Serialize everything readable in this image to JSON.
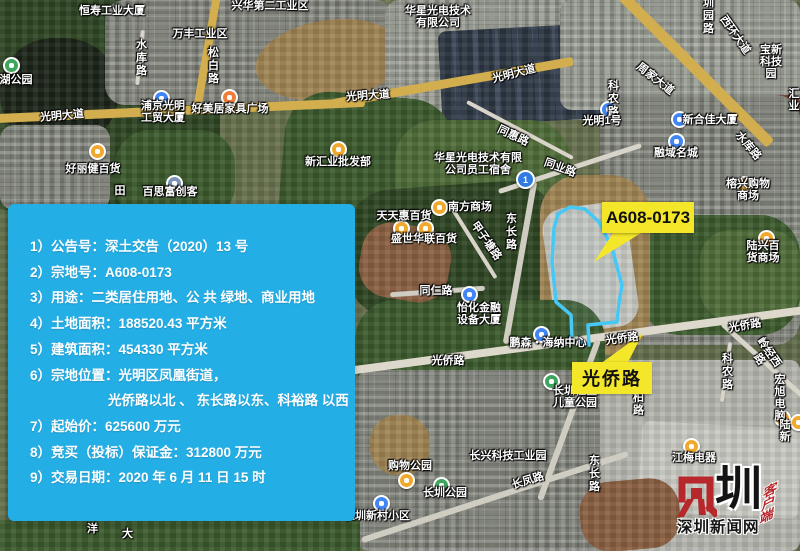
{
  "callouts": {
    "parcel": "A608-0173",
    "road": "光侨路"
  },
  "info_box": {
    "lines": [
      {
        "t": "1）公告号：深土交告（2020）13 号",
        "indent": false
      },
      {
        "t": "2）宗地号：A608-0173",
        "indent": false
      },
      {
        "t": "3）用途：二类居住用地、公 共 绿地、商业用地",
        "indent": false
      },
      {
        "t": "4）土地面积：188520.43 平方米",
        "indent": false
      },
      {
        "t": "5）建筑面积：454330 平方米",
        "indent": false
      },
      {
        "t": "6）宗地位置：光明区凤凰街道，",
        "indent": false
      },
      {
        "t": "光侨路以北 、 东长路以东、科裕路 以西",
        "indent": true
      },
      {
        "t": "7）起始价：625600 万元",
        "indent": false
      },
      {
        "t": "8）竞买（投标）保证金：312800 万元",
        "indent": false
      },
      {
        "t": "9）交易日期：2020 年 6 月 11 日 15 时",
        "indent": false
      }
    ]
  },
  "map": {
    "route_badge": "1",
    "labels": [
      {
        "t": "恒寿工业大厦",
        "x": 112,
        "y": 11
      },
      {
        "t": "兴华第二工业区",
        "x": 270,
        "y": 6
      },
      {
        "t": "万丰工业区",
        "x": 200,
        "y": 34
      },
      {
        "t": "水库路",
        "x": 140,
        "y": 58,
        "v": true
      },
      {
        "t": "松白路",
        "x": 212,
        "y": 66,
        "v": true
      },
      {
        "t": "光明大道",
        "x": 62,
        "y": 116,
        "rot": -5
      },
      {
        "t": "浦京光明\n工贸大厦",
        "x": 163,
        "y": 112
      },
      {
        "t": "好美居家具广场",
        "x": 230,
        "y": 109
      },
      {
        "t": "湖公园",
        "x": 16,
        "y": 80
      },
      {
        "t": "好丽健百货",
        "x": 93,
        "y": 169
      },
      {
        "t": "百思富创客",
        "x": 170,
        "y": 192
      },
      {
        "t": "田",
        "x": 120,
        "y": 191
      },
      {
        "t": "新汇业批发部",
        "x": 338,
        "y": 162
      },
      {
        "t": "光明大道",
        "x": 368,
        "y": 96,
        "rot": -4
      },
      {
        "t": "光明大道",
        "x": 514,
        "y": 74,
        "rot": -14
      },
      {
        "t": "华星光电技术\n有限公司",
        "x": 438,
        "y": 17
      },
      {
        "t": "圳园路",
        "x": 707,
        "y": 16,
        "v": true
      },
      {
        "t": "西环大道",
        "x": 735,
        "y": 35,
        "rot": 55
      },
      {
        "t": "宝新科技园",
        "x": 771,
        "y": 62
      },
      {
        "t": "周家大道",
        "x": 655,
        "y": 79,
        "rot": 38
      },
      {
        "t": "科农路",
        "x": 612,
        "y": 99,
        "v": true
      },
      {
        "t": "光明1号",
        "x": 602,
        "y": 121
      },
      {
        "t": "新合佳大厦",
        "x": 710,
        "y": 120
      },
      {
        "t": "融域名城",
        "x": 676,
        "y": 153
      },
      {
        "t": "水库路",
        "x": 748,
        "y": 146,
        "rot": 50
      },
      {
        "t": "汇业",
        "x": 794,
        "y": 100
      },
      {
        "t": "同惠路",
        "x": 513,
        "y": 136,
        "rot": 25
      },
      {
        "t": "华星光电技术有限\n公司员工宿舍",
        "x": 478,
        "y": 164
      },
      {
        "t": "同业路",
        "x": 560,
        "y": 168,
        "rot": 20
      },
      {
        "t": "南方商场",
        "x": 470,
        "y": 207
      },
      {
        "t": "天天惠百货",
        "x": 404,
        "y": 216
      },
      {
        "t": "盛世华联百货",
        "x": 424,
        "y": 239
      },
      {
        "t": "东长路",
        "x": 510,
        "y": 232,
        "v": true
      },
      {
        "t": "甲子塘路",
        "x": 486,
        "y": 241,
        "rot": 55
      },
      {
        "t": "同仁路",
        "x": 436,
        "y": 291
      },
      {
        "t": "榕兴购物商场",
        "x": 748,
        "y": 190
      },
      {
        "t": "陆兴百货商场",
        "x": 763,
        "y": 252
      },
      {
        "t": "怡化金融\n设备大厦",
        "x": 479,
        "y": 314
      },
      {
        "t": "鹏森・海纳中心",
        "x": 548,
        "y": 343
      },
      {
        "t": "光侨路",
        "x": 622,
        "y": 339,
        "rot": -8
      },
      {
        "t": "光侨路",
        "x": 448,
        "y": 361
      },
      {
        "t": "光侨路",
        "x": 745,
        "y": 326,
        "rot": -10
      },
      {
        "t": "岭经西路",
        "x": 764,
        "y": 356,
        "rot": 55
      },
      {
        "t": "科农路",
        "x": 726,
        "y": 372,
        "v": true
      },
      {
        "t": "柏路",
        "x": 637,
        "y": 404,
        "v": true
      },
      {
        "t": "长圳社区\n儿童公园",
        "x": 575,
        "y": 397
      },
      {
        "t": "长兴科技工业园",
        "x": 508,
        "y": 456
      },
      {
        "t": "长凤路",
        "x": 528,
        "y": 481,
        "rot": -17
      },
      {
        "t": "东长路",
        "x": 593,
        "y": 474,
        "v": true
      },
      {
        "t": "购物公园",
        "x": 410,
        "y": 466
      },
      {
        "t": "长圳公园",
        "x": 445,
        "y": 493
      },
      {
        "t": "长圳新村小区",
        "x": 377,
        "y": 516
      },
      {
        "t": "宏旭电脑",
        "x": 780,
        "y": 398
      },
      {
        "t": "陆新",
        "x": 785,
        "y": 431
      },
      {
        "t": "江梅电器",
        "x": 694,
        "y": 458
      },
      {
        "t": "洋",
        "x": 91,
        "y": 529,
        "v": true
      },
      {
        "t": "大",
        "x": 126,
        "y": 534,
        "v": true
      }
    ],
    "icons": [
      {
        "kind": "park",
        "x": 10,
        "y": 64
      },
      {
        "kind": "place",
        "x": 160,
        "y": 97
      },
      {
        "kind": "furniture",
        "x": 228,
        "y": 96
      },
      {
        "kind": "shopping",
        "x": 96,
        "y": 150
      },
      {
        "kind": "office",
        "x": 173,
        "y": 182
      },
      {
        "kind": "shopping",
        "x": 337,
        "y": 148
      },
      {
        "kind": "shopping",
        "x": 438,
        "y": 206
      },
      {
        "kind": "shopping",
        "x": 400,
        "y": 227
      },
      {
        "kind": "shopping",
        "x": 424,
        "y": 227
      },
      {
        "kind": "route",
        "x": 523,
        "y": 177
      },
      {
        "kind": "place",
        "x": 607,
        "y": 108
      },
      {
        "kind": "place",
        "x": 678,
        "y": 118
      },
      {
        "kind": "place",
        "x": 675,
        "y": 140
      },
      {
        "kind": "shopping",
        "x": 743,
        "y": 183
      },
      {
        "kind": "shopping",
        "x": 765,
        "y": 237
      },
      {
        "kind": "place",
        "x": 540,
        "y": 333
      },
      {
        "kind": "park",
        "x": 550,
        "y": 380
      },
      {
        "kind": "shopping",
        "x": 405,
        "y": 479
      },
      {
        "kind": "park",
        "x": 440,
        "y": 484
      },
      {
        "kind": "place",
        "x": 380,
        "y": 502
      },
      {
        "kind": "shopping",
        "x": 690,
        "y": 445
      },
      {
        "kind": "shopping",
        "x": 781,
        "y": 417
      },
      {
        "kind": "shopping",
        "x": 797,
        "y": 421
      },
      {
        "kind": "place",
        "x": 468,
        "y": 293
      }
    ]
  },
  "watermark": {
    "brand_char": "圳",
    "site": "深圳新闻网",
    "app": "客户端"
  },
  "colors": {
    "info_bg": "#24aee6",
    "callout_bg": "#f4e72a",
    "parcel_stroke": "#45c8f5",
    "brand_red": "#b7282c"
  }
}
